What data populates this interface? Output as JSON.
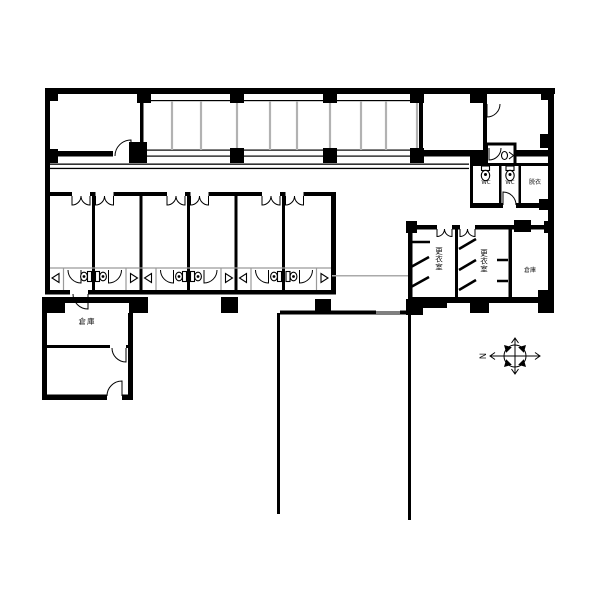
{
  "diagram": {
    "type": "architectural-floor-plan",
    "rooms": {
      "storage_left": "倉庫",
      "storage_right": "倉庫",
      "changing_room_1": "更衣室",
      "changing_room_2": "更衣室",
      "wc_1": "WC",
      "wc_2": "WC",
      "undressing_room": "脱衣"
    },
    "compass": {
      "north_label": "N",
      "north_direction": "left"
    },
    "colors": {
      "wall": "#000000",
      "background": "#ffffff",
      "partition_gray": "#b2b2b2"
    }
  }
}
